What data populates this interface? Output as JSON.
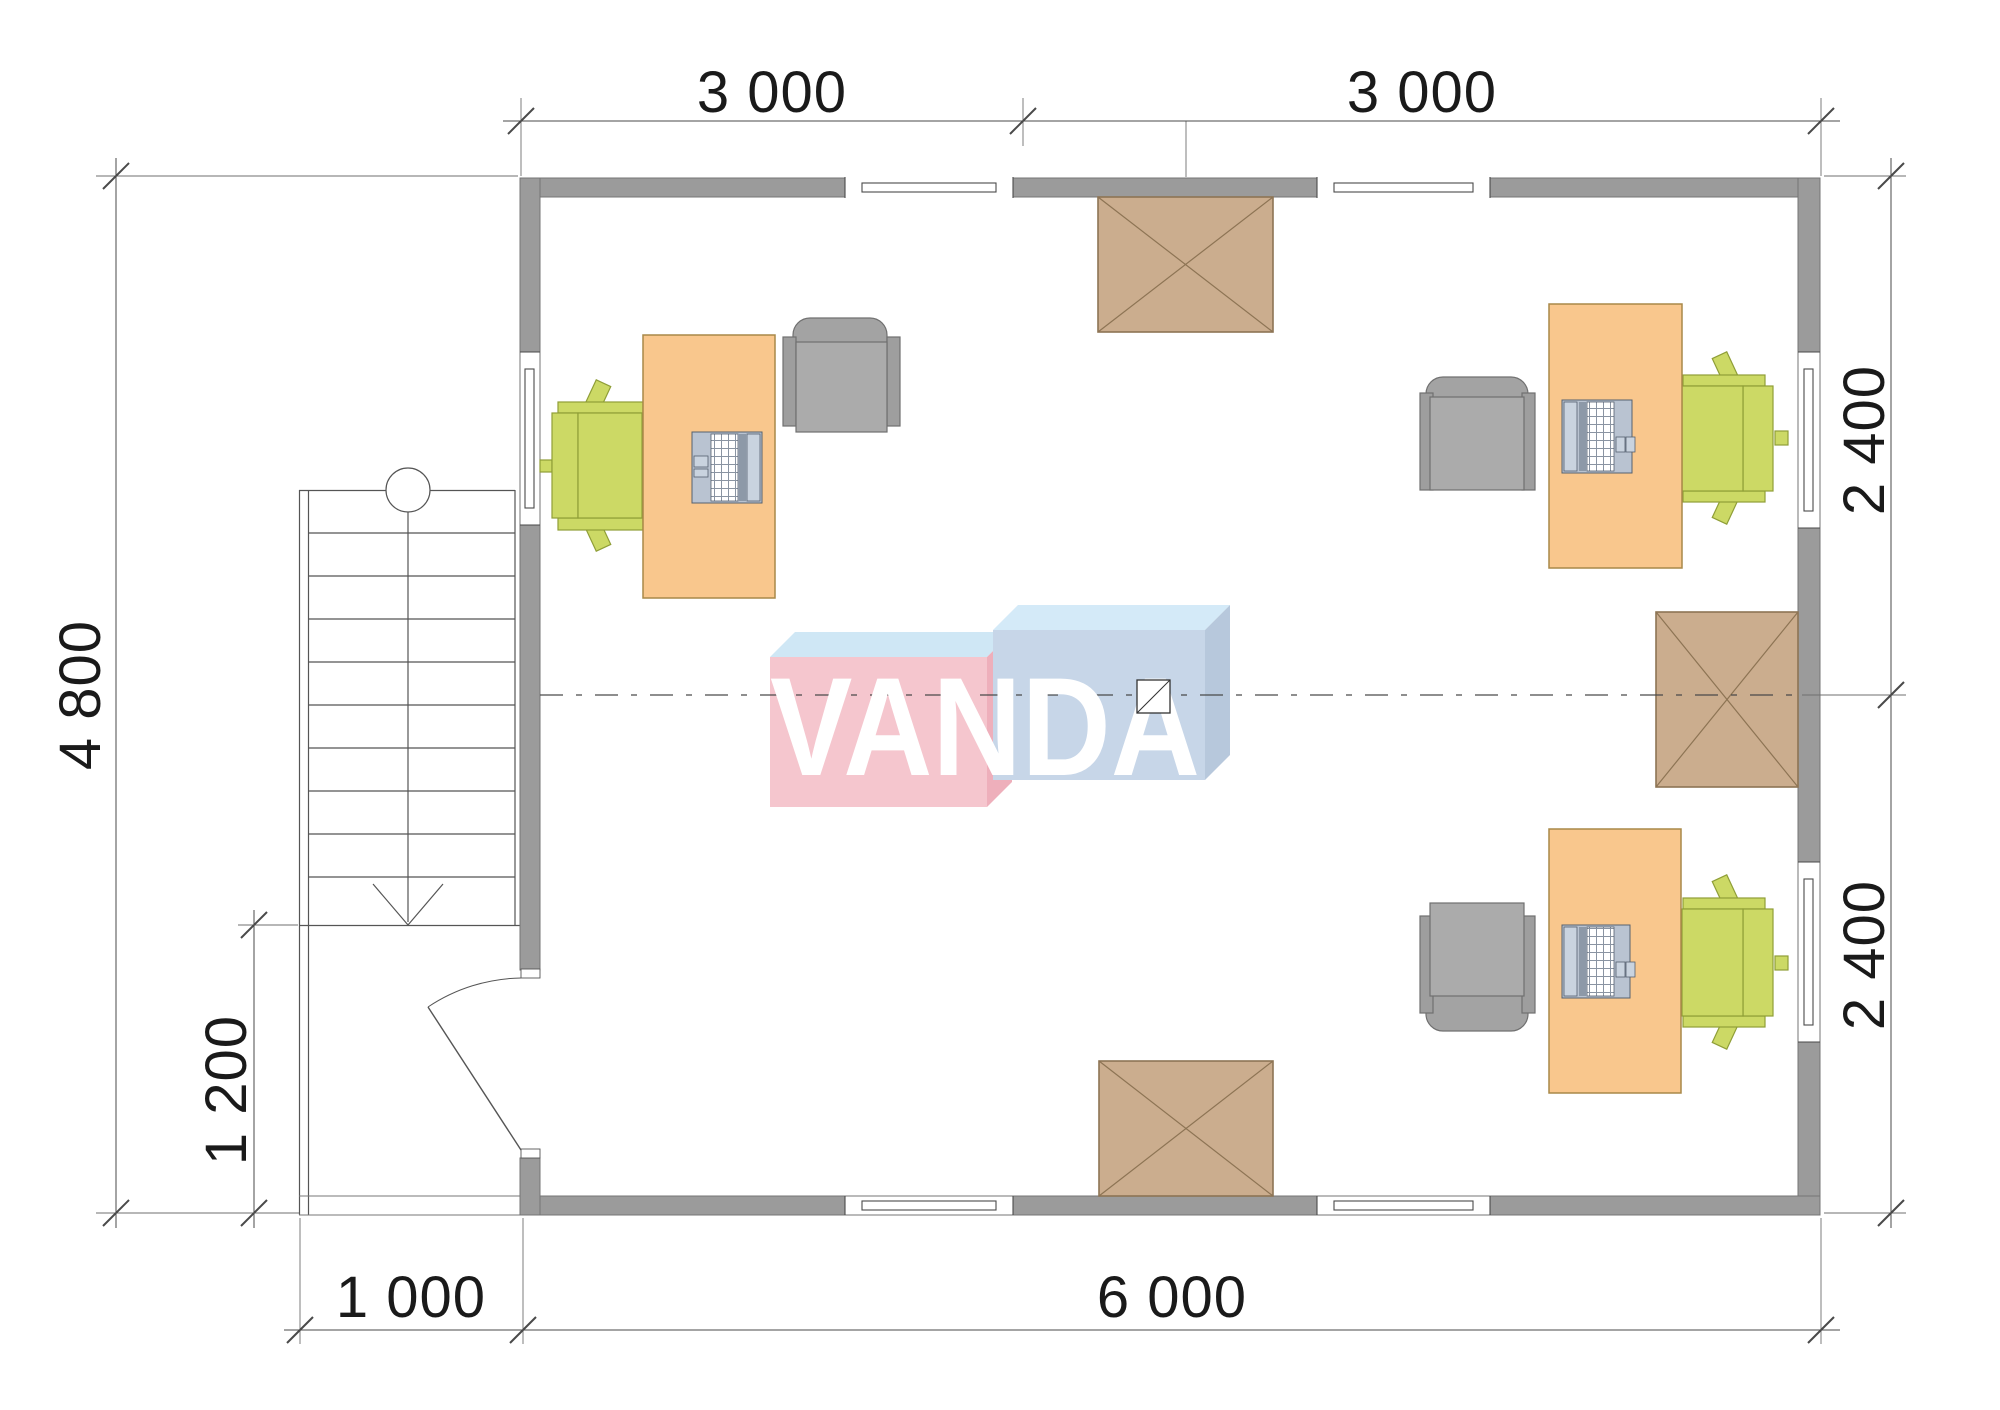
{
  "title": "office-floor-plan",
  "dims": {
    "top": [
      {
        "label": "3 000"
      },
      {
        "label": "3 000"
      }
    ],
    "left": {
      "label": "4 800"
    },
    "porch_height": {
      "label": "1 200"
    },
    "right": [
      {
        "label": "2 400"
      },
      {
        "label": "2 400"
      }
    ],
    "porch_width": {
      "label": "1 000"
    },
    "bottom": {
      "label": "6 000"
    }
  },
  "logo": {
    "text": "VANDA"
  },
  "colors": {
    "wall": "#9b9b9b",
    "desk": "#f9c78d",
    "desk_border": "#a98948",
    "chair": "#ccd965",
    "chair_border": "#8f9e37",
    "armchair_seat": "#ababab",
    "armchair_back": "#a3a3a3",
    "armchair_rest": "#9e9e9e",
    "armchair_border": "#707070",
    "skylight": "#cbad8e",
    "skylight_border": "#8d7454",
    "laptop": "#b9c3d1",
    "laptop_screen": "#c9d3df",
    "laptop_hinge": "#8d99a8",
    "laptop_border": "#55606e",
    "logo_pink": "#f5c6ce",
    "logo_pink_side": "#eeafbb",
    "logo_top_left": "#cfe7f5",
    "logo_blue": "#c7d6e8",
    "logo_blue_side": "#b7c8dc",
    "logo_top_right": "#d4eaf8",
    "logo_text": "#ffffff",
    "line": "#4a4a4a",
    "ext": "#6f6f6f",
    "dim_text": "#1a1a1a",
    "stair": "#555555",
    "porch": "#777777"
  }
}
